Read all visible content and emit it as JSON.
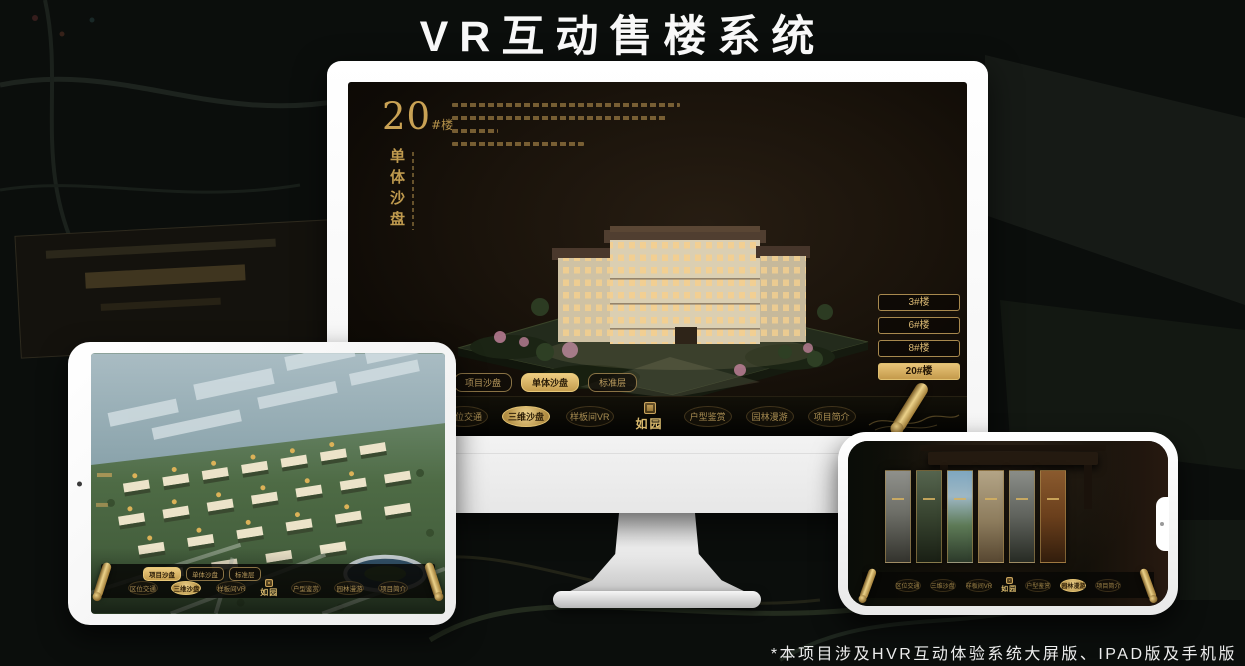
{
  "title": "VR互动售楼系统",
  "footnote": "*本项目涉及HVR互动体验系统大屏版、IPAD版及手机版",
  "logo": {
    "text": "如园"
  },
  "colors": {
    "gold": "#c9a55a",
    "gold_bright": "#e8c87e",
    "screen_brown": "#1a130b",
    "white_frame": "#f5f5f5"
  },
  "monitor": {
    "header": {
      "number": "20",
      "suffix": "#楼",
      "subtitle": "单体沙盘"
    },
    "building_buttons": [
      {
        "label": "3#楼",
        "active": false
      },
      {
        "label": "6#楼",
        "active": false
      },
      {
        "label": "8#楼",
        "active": false
      },
      {
        "label": "20#楼",
        "active": true
      }
    ],
    "sub_tabs": [
      {
        "label": "项目沙盘",
        "active": false
      },
      {
        "label": "单体沙盘",
        "active": true
      },
      {
        "label": "标准层",
        "active": false
      }
    ],
    "nav_items": [
      {
        "label": "区位交通",
        "active": false
      },
      {
        "label": "三维沙盘",
        "active": true
      },
      {
        "label": "样板间VR",
        "active": false
      },
      {
        "label": "户型鉴赏",
        "active": false
      },
      {
        "label": "园林漫游",
        "active": false
      },
      {
        "label": "项目简介",
        "active": false
      }
    ]
  },
  "tablet": {
    "sub_tabs": [
      {
        "label": "项目沙盘",
        "active": true
      },
      {
        "label": "单体沙盘",
        "active": false
      },
      {
        "label": "标准层",
        "active": false
      }
    ],
    "nav_items": [
      {
        "label": "区位交通",
        "active": false
      },
      {
        "label": "三维沙盘",
        "active": true
      },
      {
        "label": "样板间VR",
        "active": false
      },
      {
        "label": "户型鉴赏",
        "active": false
      },
      {
        "label": "园林漫游",
        "active": false
      },
      {
        "label": "项目简介",
        "active": false
      }
    ]
  },
  "phone": {
    "nav_items": [
      {
        "label": "区位交通",
        "active": false
      },
      {
        "label": "三维沙盘",
        "active": false
      },
      {
        "label": "样板间VR",
        "active": false
      },
      {
        "label": "户型鉴赏",
        "active": false
      },
      {
        "label": "园林漫游",
        "active": true
      },
      {
        "label": "项目简介",
        "active": false
      }
    ]
  }
}
